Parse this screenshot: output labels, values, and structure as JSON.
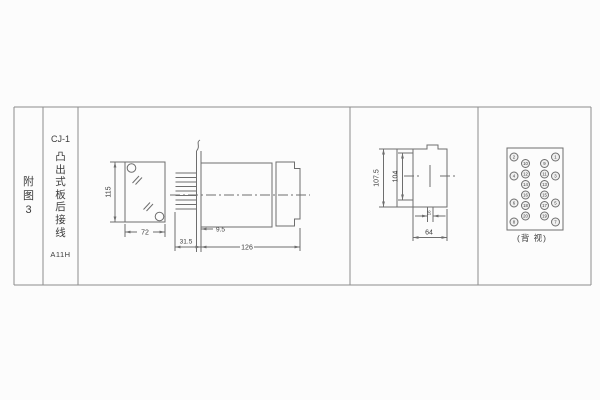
{
  "sheet": {
    "figure_label": "附图3",
    "model": "CJ-1",
    "mount_type": "凸出式板后接线",
    "doc_code": "A11H"
  },
  "views": {
    "front": {
      "height_mm": "115",
      "width_mm": "72"
    },
    "side": {
      "pin_section_mm": "31.5",
      "panel_offset_mm": "9.5",
      "length_mm": "126"
    },
    "panel_cutout": {
      "outer_mm": "107.5",
      "inner_mm": "104",
      "stud_pitch_mm": "16",
      "depth_mm": "64"
    },
    "rear": {
      "caption": "(背 视)",
      "terminals": [
        {
          "label": "2",
          "x": 514,
          "y": 157
        },
        {
          "label": "4",
          "x": 514,
          "y": 176
        },
        {
          "label": "6",
          "x": 514,
          "y": 203
        },
        {
          "label": "8",
          "x": 514,
          "y": 222
        },
        {
          "label": "10",
          "x": 525.5,
          "y": 163.5
        },
        {
          "label": "12",
          "x": 525.5,
          "y": 174
        },
        {
          "label": "14",
          "x": 525.5,
          "y": 184.5
        },
        {
          "label": "16",
          "x": 525.5,
          "y": 195
        },
        {
          "label": "18",
          "x": 525.5,
          "y": 205.5
        },
        {
          "label": "20",
          "x": 525.5,
          "y": 216
        },
        {
          "label": "9",
          "x": 544.5,
          "y": 163.5
        },
        {
          "label": "11",
          "x": 544.5,
          "y": 174
        },
        {
          "label": "13",
          "x": 544.5,
          "y": 184.5
        },
        {
          "label": "15",
          "x": 544.5,
          "y": 195
        },
        {
          "label": "17",
          "x": 544.5,
          "y": 205.5
        },
        {
          "label": "19",
          "x": 544.5,
          "y": 216
        },
        {
          "label": "1",
          "x": 555.5,
          "y": 157
        },
        {
          "label": "3",
          "x": 555.5,
          "y": 176
        },
        {
          "label": "5",
          "x": 555.5,
          "y": 203
        },
        {
          "label": "7",
          "x": 555.5,
          "y": 222
        }
      ]
    }
  },
  "colors": {
    "drawing_line": "#6e6e6e",
    "table_line": "#8d8d8d",
    "text": "#3c3c3c",
    "background": "#fcfcfc"
  }
}
